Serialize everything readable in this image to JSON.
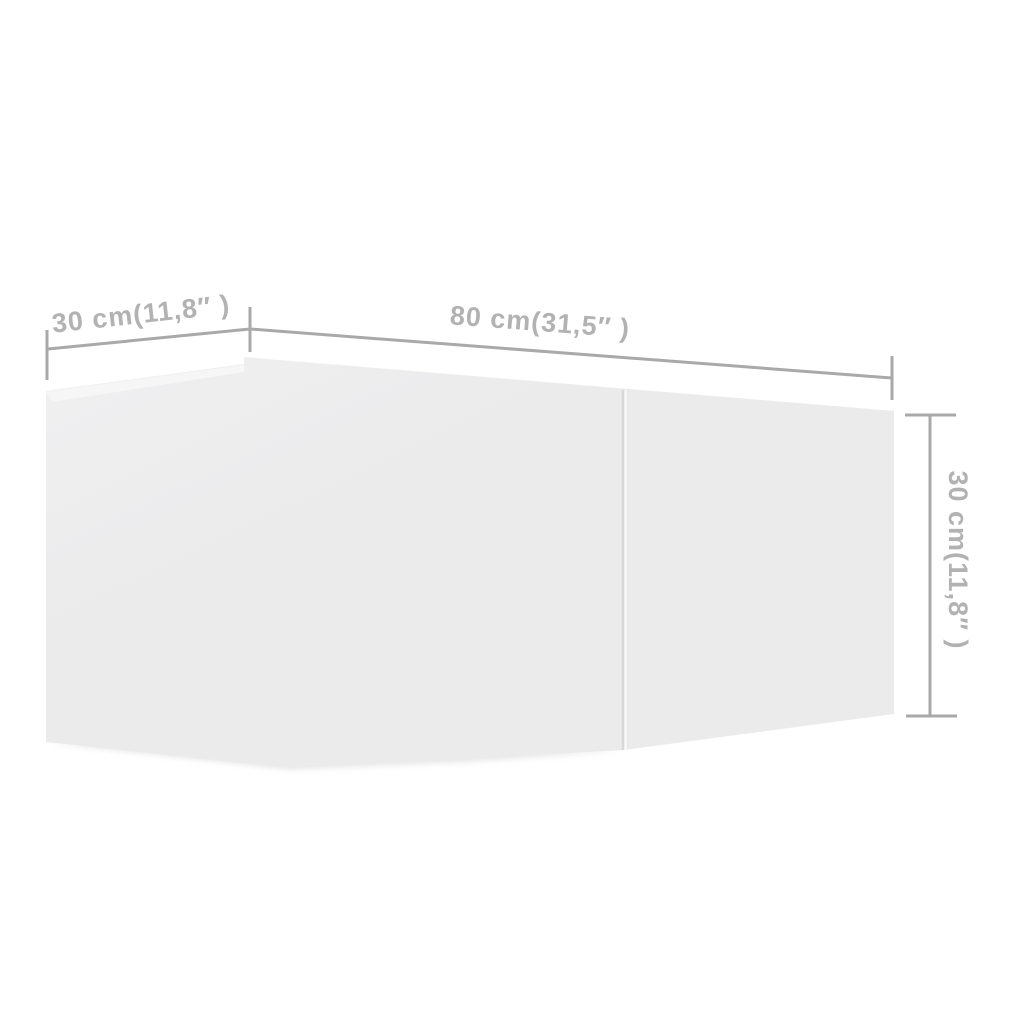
{
  "page": {
    "background_color": "#ffffff",
    "description_label": "Product dimension diagram of a white wall-mounted TV cabinet"
  },
  "diagram": {
    "type": "product-dimension-diagram",
    "canvas": {
      "width": 1024,
      "height": 1024
    },
    "box": {
      "face_fill": "#ebebec",
      "face_fill_light": "#f0f0f1",
      "top_wedge_fill": "#f6f6f7",
      "shadow_fill": "#e3e3e5",
      "divider_color": "#d9d9db",
      "divider_highlight_color": "#fafafb",
      "silhouette": [
        [
          46,
          391
        ],
        [
          244,
          364
        ],
        [
          244,
          357
        ],
        [
          894,
          411
        ],
        [
          894,
          714
        ],
        [
          624,
          750
        ],
        [
          290,
          768
        ],
        [
          46,
          742
        ]
      ],
      "top_wedge": [
        [
          46,
          392
        ],
        [
          244,
          365
        ],
        [
          244,
          372
        ],
        [
          52,
          402
        ]
      ],
      "divider": {
        "x1": 623,
        "y1": 390,
        "x2": 623,
        "y2": 750
      },
      "shadow": [
        [
          46,
          742
        ],
        [
          624,
          750
        ],
        [
          470,
          761
        ],
        [
          290,
          769
        ]
      ]
    },
    "style": {
      "line_color": "#a9a9a9",
      "line_width": 3,
      "text_color": "#b2b2b2",
      "font_size": 27
    },
    "dimensions": [
      {
        "id": "depth",
        "value_cm": 30,
        "value_inch": "11,8",
        "label": "30 cm(11,8″ )",
        "line": [
          48,
          349,
          250,
          329
        ],
        "ticks": [
          [
            47,
            330,
            47,
            380
          ],
          [
            250,
            307,
            250,
            352
          ]
        ],
        "label_pos": [
          141,
          314
        ],
        "label_rotation": -6.3
      },
      {
        "id": "width",
        "value_cm": 80,
        "value_inch": "31,5",
        "label": "80 cm(31,5″ )",
        "line": [
          250,
          329,
          892,
          378
        ],
        "ticks": [
          [
            892,
            356,
            892,
            400
          ]
        ],
        "label_pos": [
          540,
          322
        ],
        "label_rotation": 4.3
      },
      {
        "id": "height",
        "value_cm": 30,
        "value_inch": "11,8",
        "label": "30 cm(11,8″ )",
        "line": [
          930,
          415,
          930,
          716
        ],
        "ticks": [
          [
            905,
            415,
            956,
            415
          ],
          [
            906,
            716,
            957,
            716
          ]
        ],
        "label_pos": [
          958,
          560
        ],
        "label_rotation": 90
      }
    ]
  }
}
